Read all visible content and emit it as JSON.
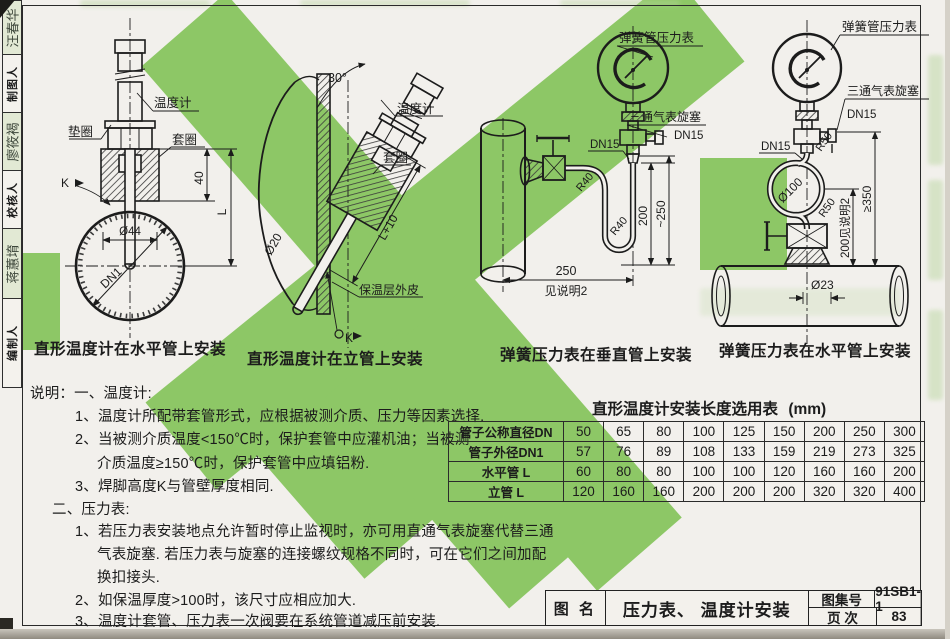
{
  "colors": {
    "watermark_green": "#8dc766",
    "paper": "#f2f0ec",
    "ink": "#1c1c1c"
  },
  "sidebar": {
    "items": [
      {
        "name": "汪春华",
        "label": "制图人"
      },
      {
        "name": "廖筱褐",
        "label": "校核人"
      },
      {
        "name": "蒋蕙堉",
        "label": "编制人"
      }
    ]
  },
  "diagrams": [
    {
      "caption": "直形温度计在水平管上安装",
      "labels": {
        "thermometer": "温度计",
        "washer": "垫圈",
        "ferrule": "套圈",
        "dim40": "40",
        "dimL": "L",
        "dia44": "Ø44",
        "dn1": "DN1",
        "weldK": "K"
      }
    },
    {
      "caption": "直形温度计在立管上安装",
      "labels": {
        "angle": "30°",
        "thermometer": "温度计",
        "ferrule": "套圈",
        "dimL10": "L+10",
        "dia20": "Ø20",
        "insulation": "保温层外皮",
        "weldK": "K"
      }
    },
    {
      "caption": "弹簧压力表在垂直管上安装",
      "labels": {
        "gauge": "弹簧管压力表",
        "cock": "三通气表旋塞",
        "dn15a": "DN15",
        "dn15b": "DN15",
        "r40a": "R40",
        "r40b": "R40",
        "dim200": "200",
        "dim250v": "~250",
        "dim250": "250",
        "seenote": "见说明2"
      }
    },
    {
      "caption": "弹簧压力表在水平管上安装",
      "labels": {
        "gauge": "弹簧管压力表",
        "cock": "三通气表旋塞",
        "dn15a": "DN15",
        "dn15b": "DN15",
        "r50a": "R50",
        "r50b": "R50",
        "dia100": "Ø100",
        "dim350": "≥350",
        "dim200note": "200见说明2",
        "dia23": "Ø23"
      }
    }
  ],
  "notes": {
    "lines": [
      "说明：一、温度计:",
      "1、温度计所配带套管形式，应根据被测介质、压力等因素选择.",
      "2、当被测介质温度<150℃时，保护套管中应灌机油；当被测",
      "介质温度≥150℃时，保护套管中应填铝粉.",
      "3、焊脚高度K与管壁厚度相同.",
      "二、压力表:",
      "1、若压力表安装地点允许暂时停止监视时，亦可用直通气表旋塞代替三通",
      "气表旋塞. 若压力表与旋塞的连接螺纹规格不同时，可在它们之间加配",
      "换扣接头.",
      "2、如保温厚度>100时，该尺寸应相应加大.",
      "3、温度计套管、压力表一次阀要在系统管道减压前安装."
    ]
  },
  "table": {
    "title": "直形温度计安装长度选用表",
    "unit": "(mm)",
    "rows": [
      {
        "header": "管子公称直径DN",
        "values": [
          "50",
          "65",
          "80",
          "100",
          "125",
          "150",
          "200",
          "250",
          "300"
        ]
      },
      {
        "header": "管子外径DN1",
        "values": [
          "57",
          "76",
          "89",
          "108",
          "133",
          "159",
          "219",
          "273",
          "325"
        ]
      },
      {
        "header": "水平管 L",
        "values": [
          "60",
          "80",
          "80",
          "100",
          "100",
          "120",
          "160",
          "160",
          "200"
        ]
      },
      {
        "header": "立管 L",
        "values": [
          "120",
          "160",
          "160",
          "200",
          "200",
          "200",
          "320",
          "320",
          "400"
        ]
      }
    ]
  },
  "title_block": {
    "name_label": "图 名",
    "drawing_title": "压力表、 温度计安装",
    "atlas_label": "图集号",
    "atlas_no": "91SB1-1",
    "page_label": "页 次",
    "page_no": "83"
  }
}
